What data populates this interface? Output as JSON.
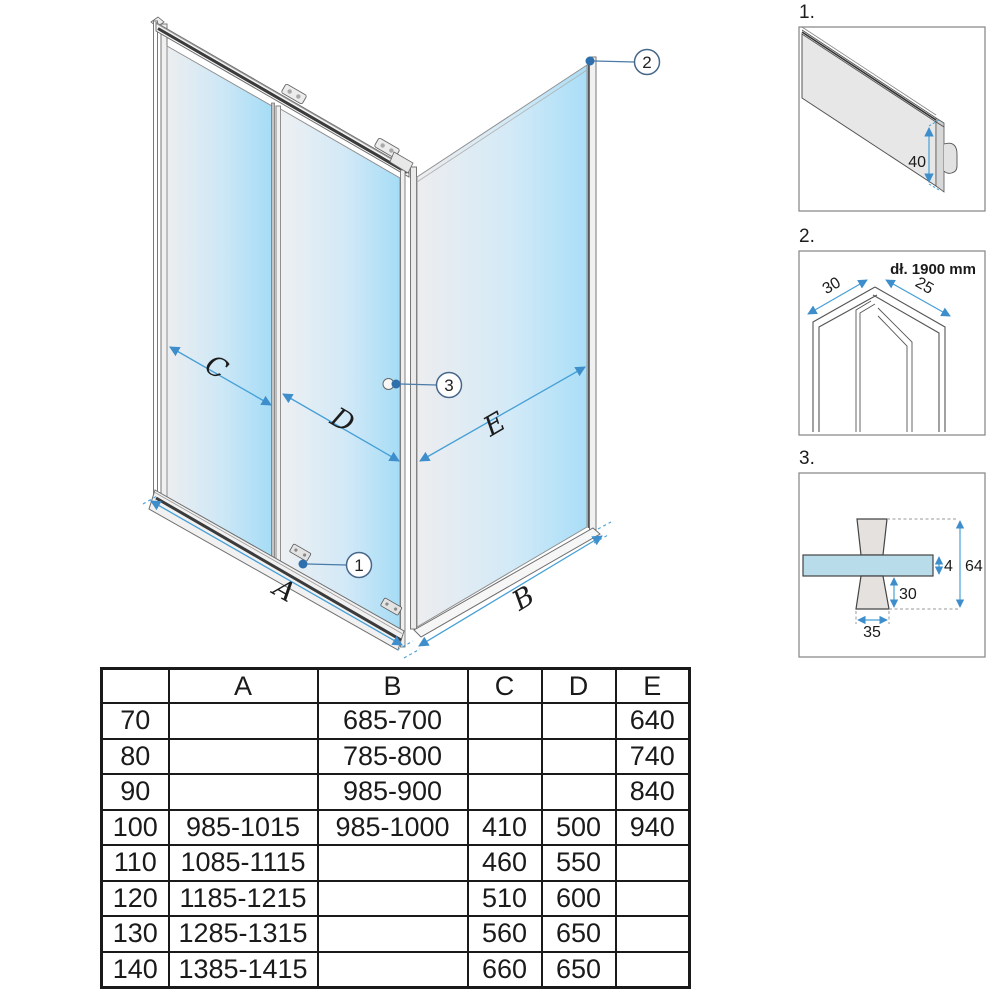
{
  "main_diagram": {
    "dim_labels": {
      "A": "A",
      "B": "B",
      "C": "C",
      "D": "D",
      "E": "E"
    },
    "callouts": {
      "c1": "1",
      "c2": "2",
      "c3": "3"
    }
  },
  "details": [
    {
      "label": "1.",
      "dims": {
        "d40": "40"
      }
    },
    {
      "label": "2.",
      "length_note": "dł. 1900 mm",
      "dims": {
        "d30": "30",
        "d25": "25"
      }
    },
    {
      "label": "3.",
      "dims": {
        "d4": "4",
        "d64": "64",
        "d30": "30",
        "d35": "35"
      }
    }
  ],
  "table": {
    "headers": [
      "",
      "A",
      "B",
      "C",
      "D",
      "E"
    ],
    "rows": [
      [
        "70",
        "",
        "685-700",
        "",
        "",
        "640"
      ],
      [
        "80",
        "",
        "785-800",
        "",
        "",
        "740"
      ],
      [
        "90",
        "",
        "985-900",
        "",
        "",
        "840"
      ],
      [
        "100",
        "985-1015",
        "985-1000",
        "410",
        "500",
        "940"
      ],
      [
        "110",
        "1085-1115",
        "",
        "460",
        "550",
        ""
      ],
      [
        "120",
        "1185-1215",
        "",
        "510",
        "600",
        ""
      ],
      [
        "130",
        "1285-1315",
        "",
        "560",
        "650",
        ""
      ],
      [
        "140",
        "1385-1415",
        "",
        "660",
        "650",
        ""
      ]
    ]
  },
  "colors": {
    "dimension_blue": "#459fd6",
    "callout_blue": "#2e6fae",
    "glass_blue": "#a9def6",
    "glass_gray": "#ededef",
    "frame_gray": "#f1f1f1",
    "line_dark": "#3b3b3b"
  }
}
